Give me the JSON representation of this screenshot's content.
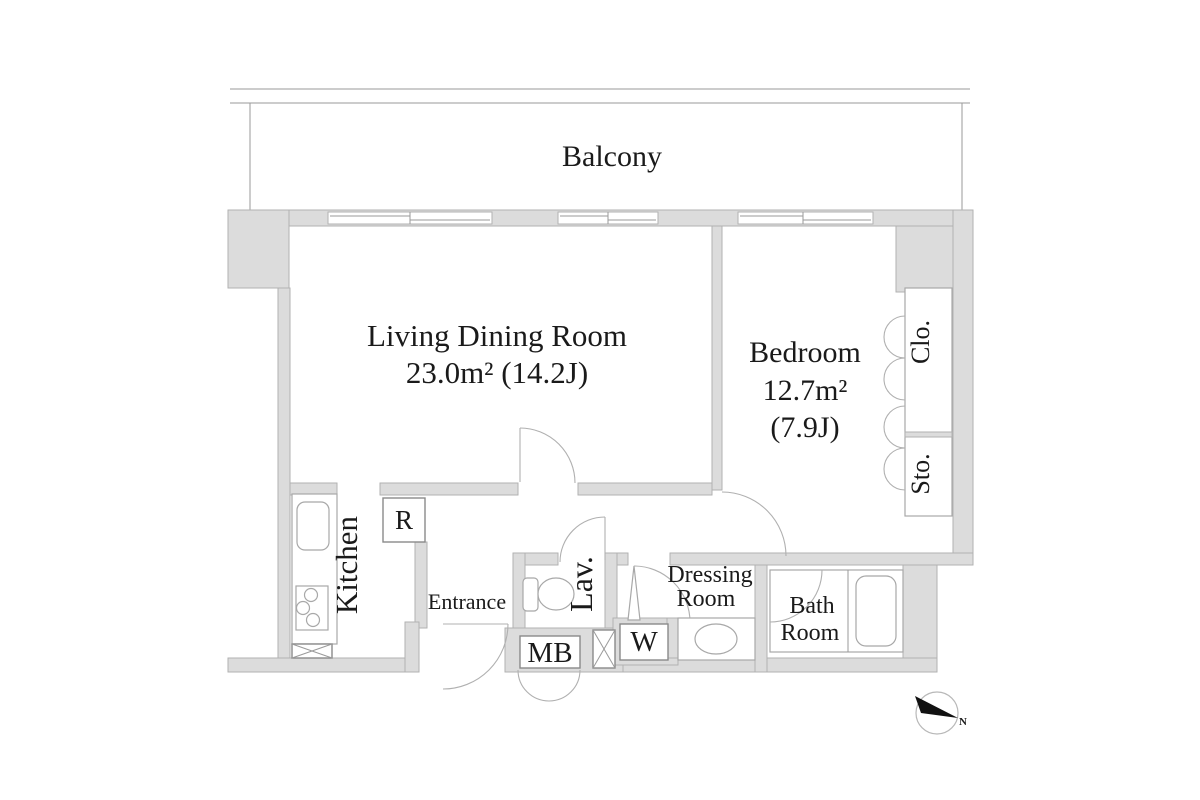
{
  "plan_type": "floor-plan",
  "colors": {
    "wall_fill": "#dcdcdc",
    "wall_stroke": "#b2b2b2",
    "line_color": "#9a9a9a",
    "fixture_stroke": "#a8a8a8",
    "text_color": "#1a1a1a",
    "compass_black": "#111111"
  },
  "balcony": {
    "label": "Balcony"
  },
  "living_dining": {
    "name": "Living Dining Room",
    "area": "23.0m² (14.2J)"
  },
  "bedroom": {
    "name": "Bedroom",
    "area_m2": "12.7m²",
    "area_j": "(7.9J)"
  },
  "kitchen": {
    "label": "Kitchen",
    "fridge_label": "R"
  },
  "entrance": {
    "label": "Entrance"
  },
  "lavatory": {
    "label": "Lav."
  },
  "meter_box": {
    "label": "MB"
  },
  "washer": {
    "label": "W"
  },
  "dressing_room": {
    "line1": "Dressing",
    "line2": "Room"
  },
  "bath_room": {
    "line1": "Bath",
    "line2": "Room"
  },
  "closet": {
    "label": "Clo."
  },
  "storage": {
    "label": "Sto."
  },
  "compass": {
    "north_label": "N"
  }
}
